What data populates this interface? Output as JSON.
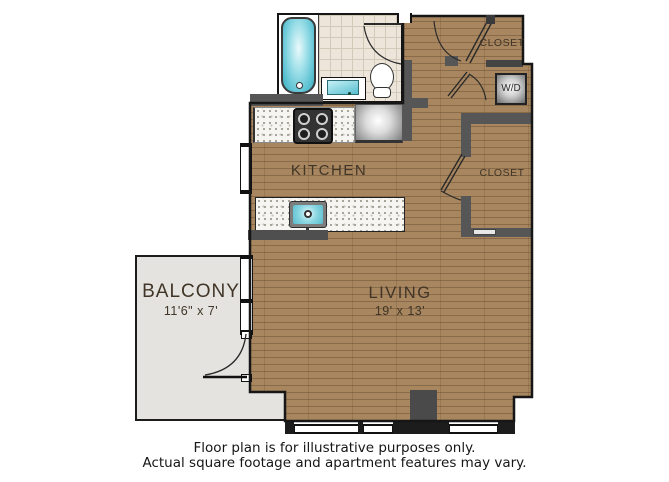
{
  "rooms": {
    "kitchen": {
      "label": "KITCHEN"
    },
    "living": {
      "label": "LIVING",
      "dimensions": "19' x 13'"
    },
    "balcony": {
      "label": "BALCONY",
      "dimensions": "11'6\" x 7'"
    },
    "closet_upper": {
      "label": "CLOSET"
    },
    "closet_lower": {
      "label": "CLOSET"
    },
    "laundry": {
      "label": "W/D"
    }
  },
  "fixtures": [
    "bathtub",
    "bathroom-sink",
    "toilet",
    "stove",
    "refrigerator",
    "kitchen-sink",
    "washer-dryer",
    "windows",
    "doors"
  ],
  "disclaimer": {
    "line1": "Floor plan is for illustrative purposes only.",
    "line2": "Actual square footage and apartment features may vary."
  },
  "colors": {
    "wood_floor": "#a8865f",
    "balcony_floor": "#e4e3e0",
    "wall": "#565656",
    "tile": "#ede5d9",
    "fixture_teal": "#63c5d5",
    "counter_speckle": "#f6f5f1"
  }
}
